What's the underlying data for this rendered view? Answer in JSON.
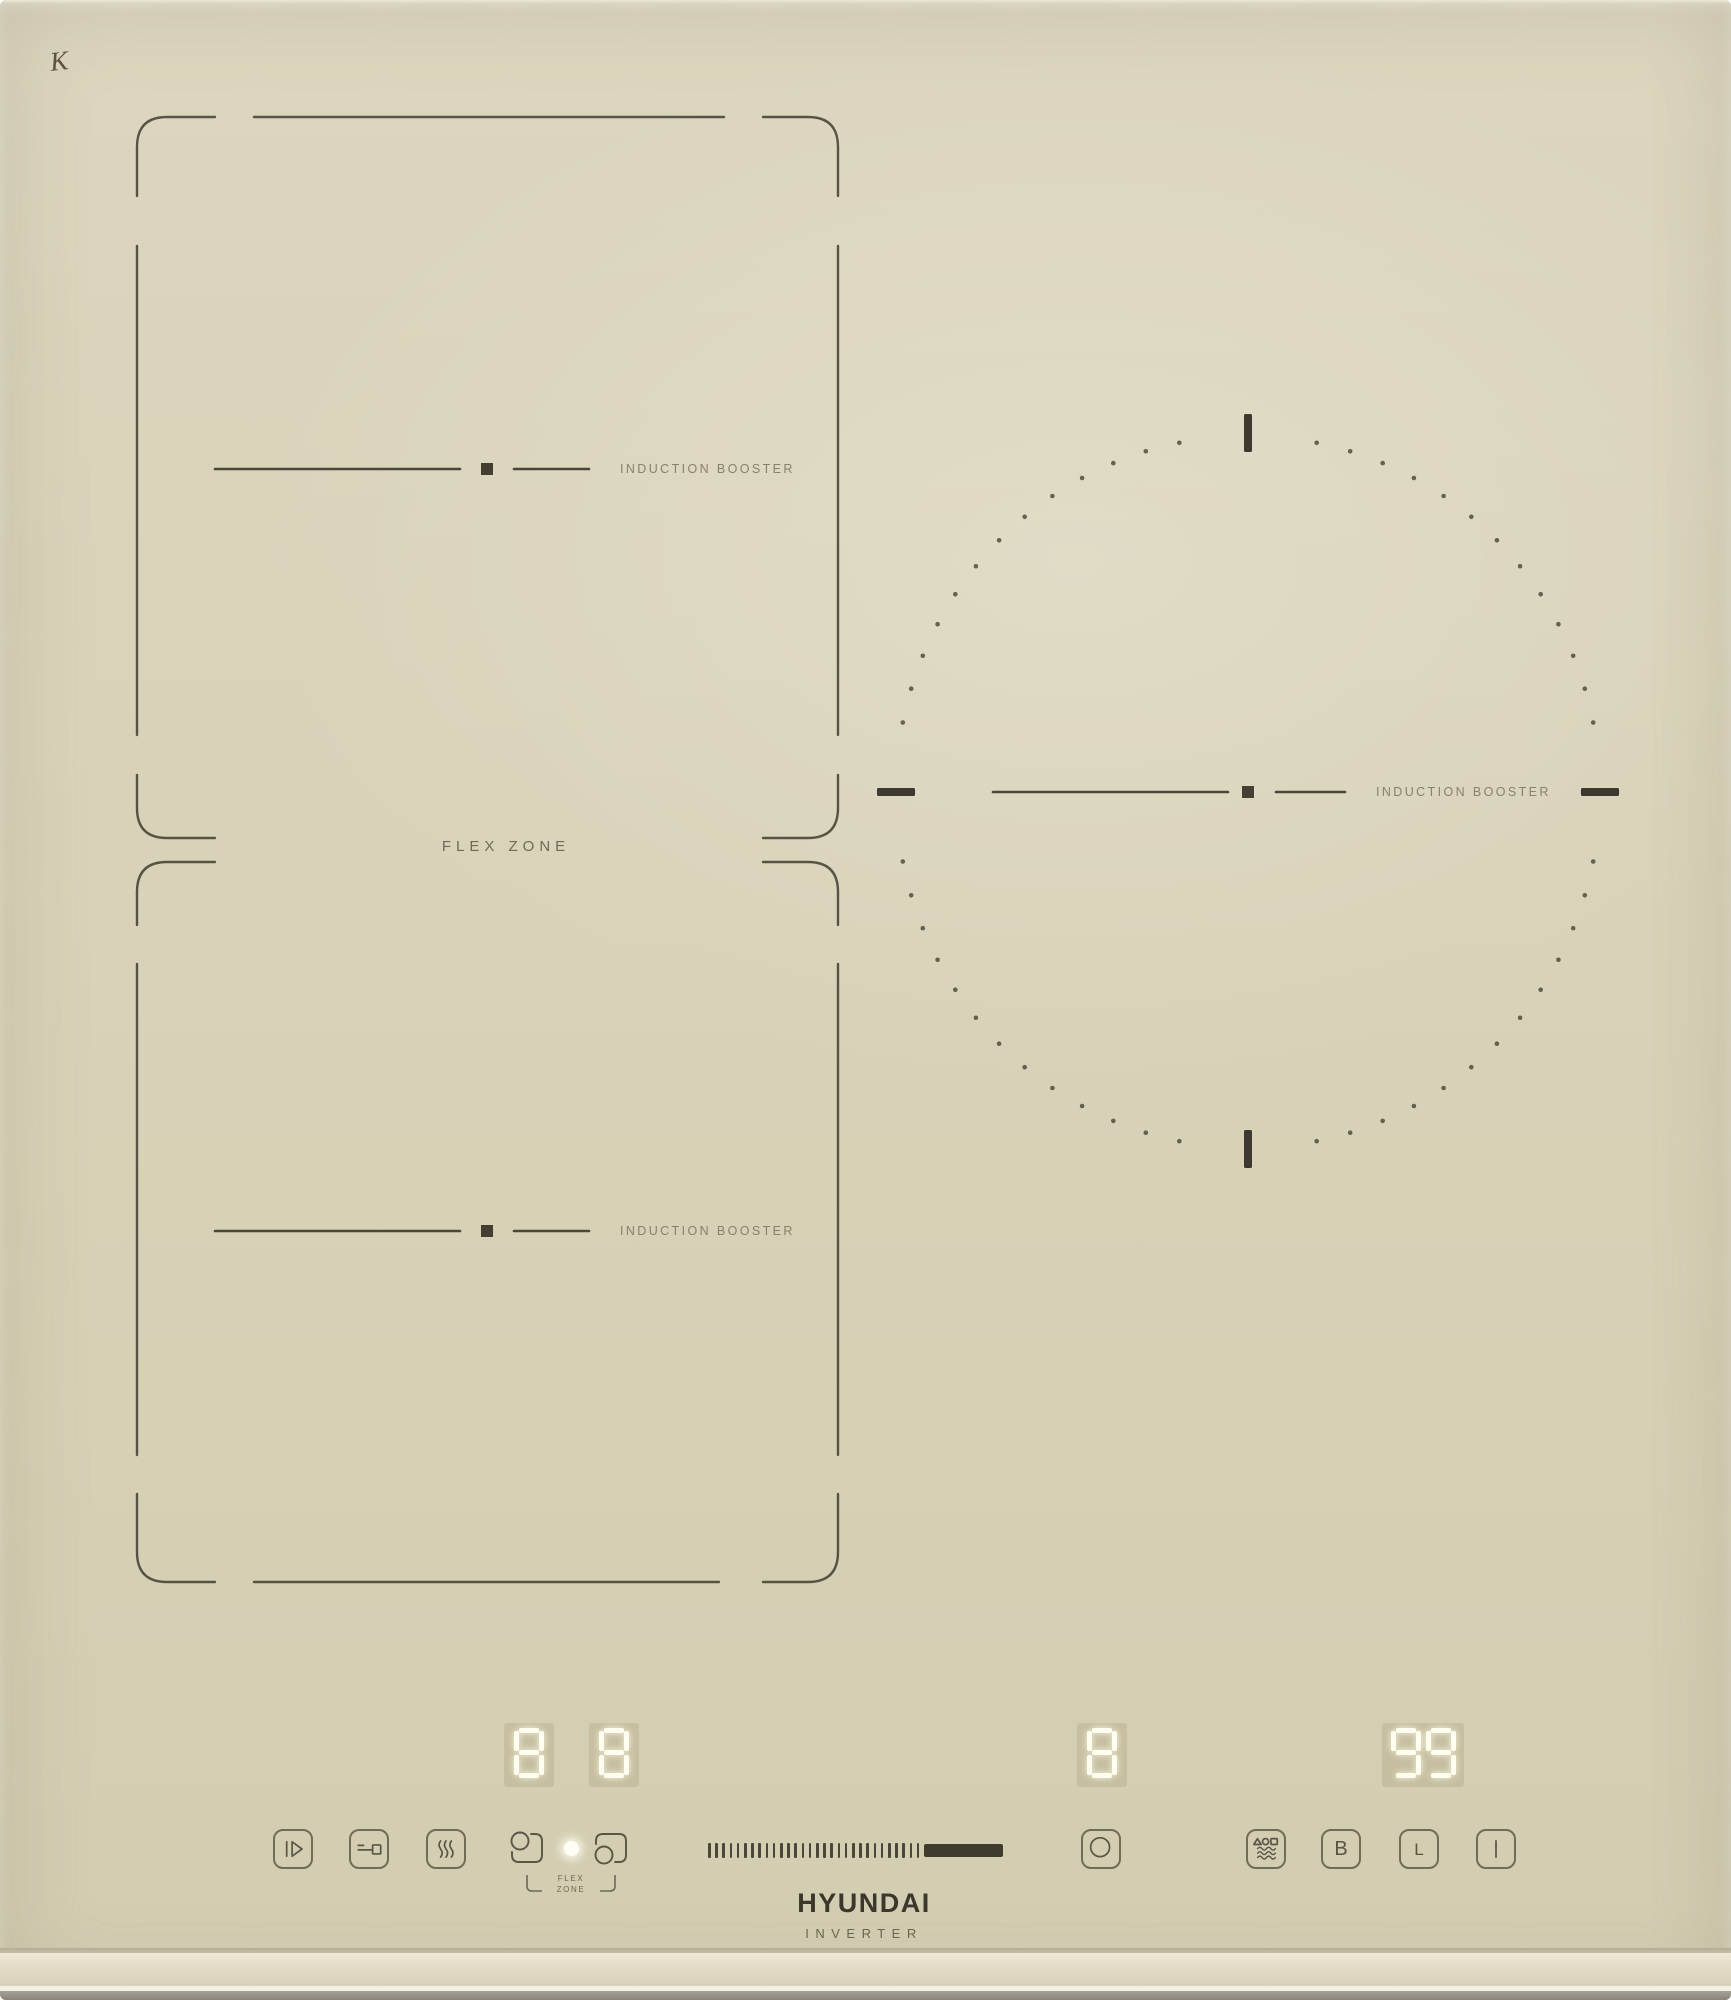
{
  "branding": {
    "logo": "HYUNDAI",
    "tagline": "INVERTER",
    "corner_mark": "K"
  },
  "surface": {
    "flex_zone_label": "FLEX ZONE",
    "left_top_zone_label": "INDUCTION BOOSTER",
    "left_bottom_zone_label": "INDUCTION BOOSTER",
    "right_zone_label": "INDUCTION BOOSTER"
  },
  "displays": {
    "left_top": "8",
    "left_bottom": "8",
    "right": "8",
    "timer": "99"
  },
  "controls": {
    "flex_bridge_line1": "FLEX",
    "flex_bridge_line2": "ZONE",
    "boost_label": "B",
    "lock_label": "L",
    "slider": {
      "ticks": 30
    }
  },
  "colors": {
    "glass": "#d8d2b8",
    "line": "#4d483b",
    "label": "#87816e",
    "digit": "#fffdf0",
    "slider_bar": "#3f3b2f"
  }
}
